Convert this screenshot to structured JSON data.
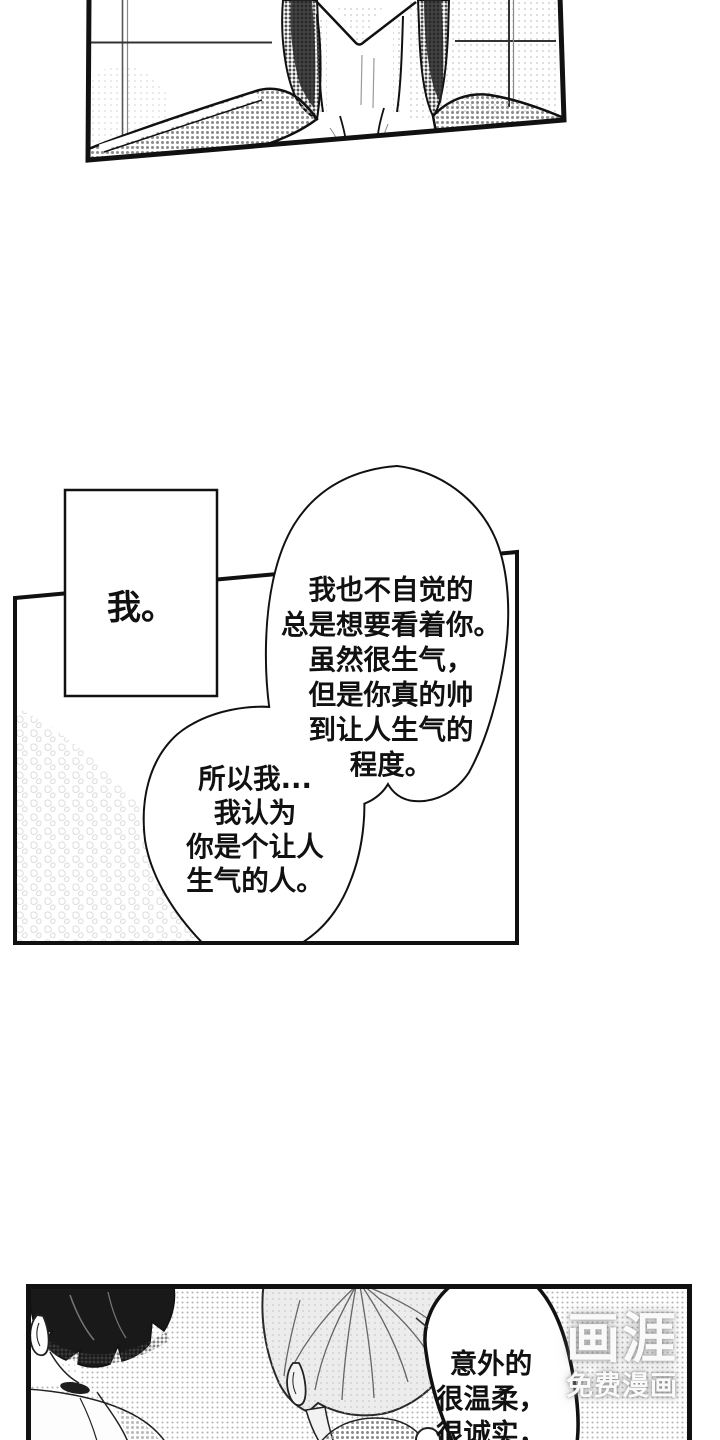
{
  "colors": {
    "ink": "#111111",
    "paper": "#ffffff",
    "halftone_light": "#b4b4b4",
    "halftone_mid": "#8b8b8b",
    "hair_black": "#191919",
    "watermark_text": "#ffffff"
  },
  "panel_middle": {
    "caption": "我。",
    "main_bubble_lines": [
      "我也不自觉的",
      "总是想要看着你。",
      "虽然很生气，",
      "但是你真的帅",
      "到让人生气的",
      "程度。"
    ],
    "sub_bubble_lines": [
      "所以我...",
      "我认为",
      "你是个让人",
      "生气的人。"
    ]
  },
  "panel_bottom": {
    "bubble_lines": [
      "意外的",
      "很温柔，",
      "很诚实，"
    ]
  },
  "watermark": {
    "brand": "画涯",
    "tagline": "免费漫画"
  }
}
